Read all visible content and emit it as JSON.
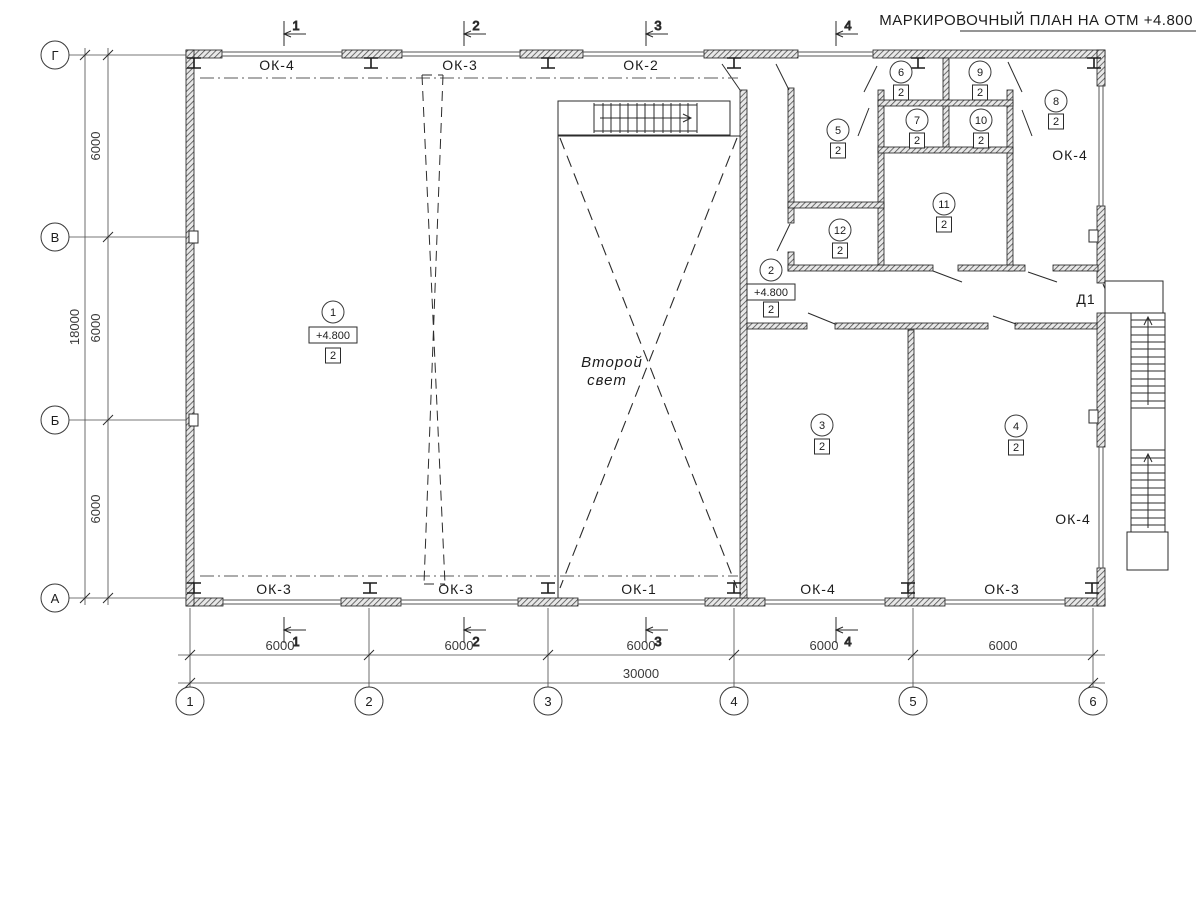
{
  "title": "МАРКИРОВОЧНЫЙ ПЛАН НА ОТМ +4.800",
  "axes": {
    "rows": [
      "Г",
      "В",
      "Б",
      "А"
    ],
    "cols": [
      "1",
      "2",
      "3",
      "4",
      "5",
      "6"
    ]
  },
  "dims": {
    "left": [
      "6000",
      "6000",
      "6000"
    ],
    "left_total": "18000",
    "bottom": [
      "6000",
      "6000",
      "6000",
      "6000",
      "6000"
    ],
    "bottom_total": "30000"
  },
  "marks": {
    "sections": [
      "1",
      "2",
      "3",
      "4"
    ]
  },
  "windows": {
    "top": [
      "ОК-4",
      "ОК-3",
      "ОК-2"
    ],
    "bottom": [
      "ОК-3",
      "ОК-3",
      "ОК-1",
      "ОК-4",
      "ОК-3"
    ],
    "right_top": "ОК-4",
    "right_bottom": "ОК-4"
  },
  "door": "Д1",
  "void_label": {
    "line1": "Второй",
    "line2": "свет"
  },
  "rooms": [
    {
      "num": "1",
      "type": "2",
      "elev": "+4.800"
    },
    {
      "num": "2",
      "type": "2",
      "elev": "+4.800"
    },
    {
      "num": "3",
      "type": "2"
    },
    {
      "num": "4",
      "type": "2"
    },
    {
      "num": "5",
      "type": "2"
    },
    {
      "num": "6",
      "type": "2"
    },
    {
      "num": "7",
      "type": "2"
    },
    {
      "num": "8",
      "type": "2"
    },
    {
      "num": "9",
      "type": "2"
    },
    {
      "num": "10",
      "type": "2"
    },
    {
      "num": "11",
      "type": "2"
    },
    {
      "num": "12",
      "type": "2"
    }
  ]
}
